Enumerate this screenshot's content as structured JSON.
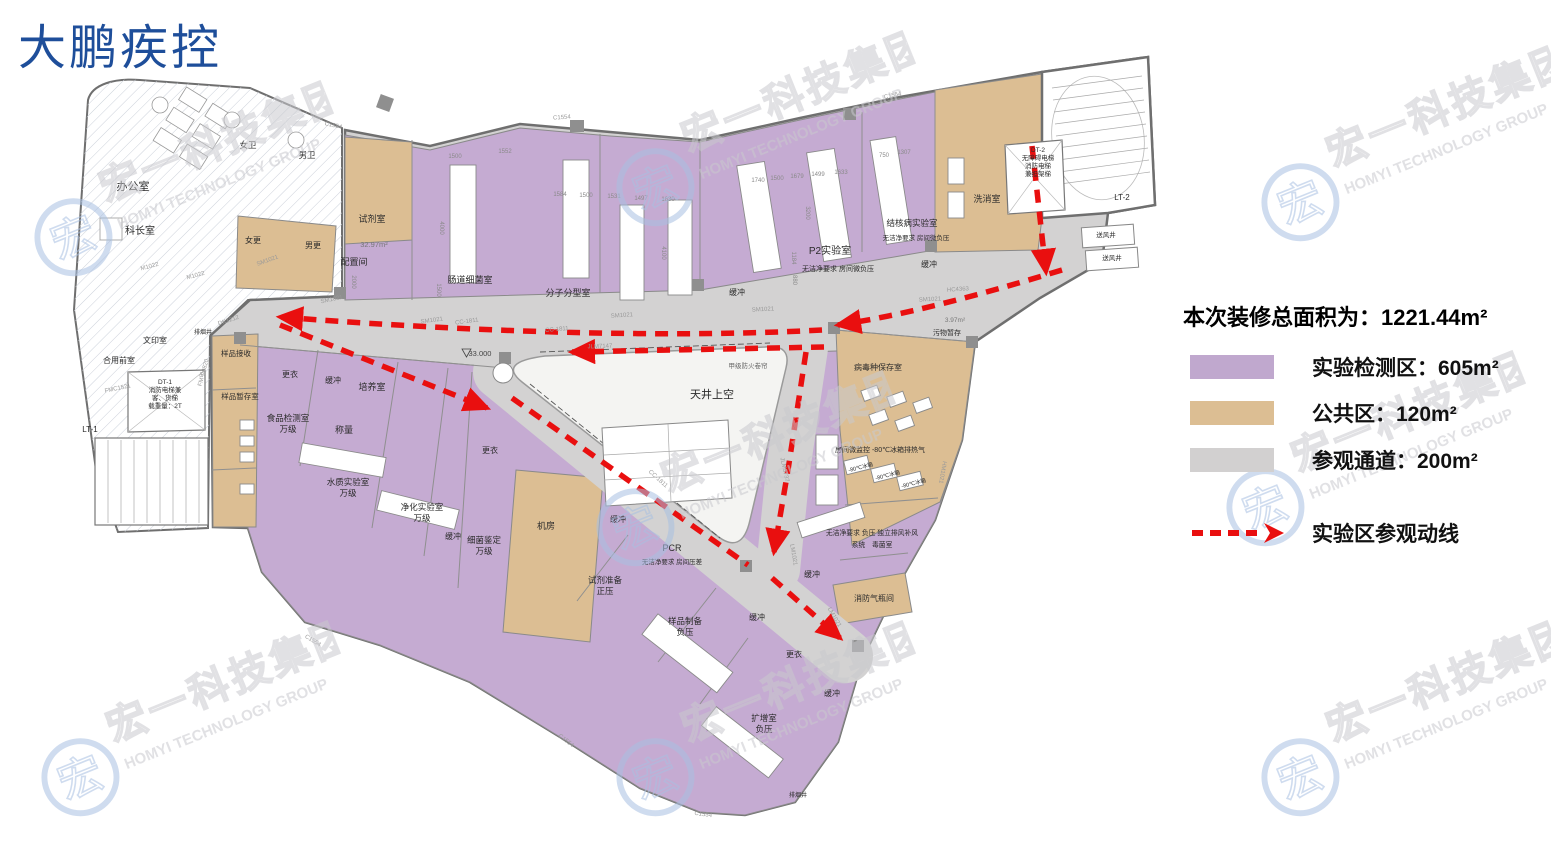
{
  "title": "大鹏疾控",
  "watermark": {
    "cn": "宏一科技集团",
    "en": "HOMYI TECHNOLOGY GROUP",
    "logo_char": "宏",
    "blue": "#a9c0e2",
    "gray": "#c9c9ce"
  },
  "legend": {
    "total_label": "本次装修总面积为：",
    "total_value": "1221.44m²",
    "items": [
      {
        "label": "实验检测区：605m²",
        "color": "#c0a8ce"
      },
      {
        "label": "公共区：120m²",
        "color": "#dcbe93"
      },
      {
        "label": "参观通道：200m²",
        "color": "#d2d0d0"
      }
    ],
    "route_label": "实验区参观动线",
    "route_color": "#e90f0f"
  },
  "floorplan": {
    "colors": {
      "lab_purple": "#c5abd2",
      "public_tan": "#dcbe93",
      "corridor_gray": "#d3d2d2",
      "route_red": "#e90f0f"
    },
    "atrium_label": "天井上空",
    "elevation_marker": "33.000",
    "rooms": [
      {
        "label": "办公室",
        "x": 133,
        "y": 190,
        "s": 11
      },
      {
        "label": "科长室",
        "x": 140,
        "y": 234,
        "s": 10
      },
      {
        "label": "女卫",
        "x": 248,
        "y": 148,
        "s": 8.5
      },
      {
        "label": "男卫",
        "x": 307,
        "y": 158,
        "s": 8.5
      },
      {
        "label": "文印室",
        "x": 155,
        "y": 343,
        "s": 8
      },
      {
        "label": "合用前室",
        "x": 119,
        "y": 363,
        "s": 8
      },
      {
        "lines": [
          "DT-1",
          "消防电梯兼",
          "客、货梯",
          "载重量：2T"
        ],
        "x": 165,
        "y": 384,
        "s": 6.5,
        "lh": 8
      },
      {
        "label": "LT-1",
        "x": 90,
        "y": 432,
        "s": 8
      },
      {
        "label": "排烟井",
        "x": 203,
        "y": 334,
        "s": 6
      },
      {
        "label": "样品接收",
        "x": 236,
        "y": 356,
        "s": 7.5
      },
      {
        "label": "样品暂存室",
        "x": 240,
        "y": 399,
        "s": 7.5
      },
      {
        "label": "女更",
        "x": 253,
        "y": 243,
        "s": 8
      },
      {
        "label": "男更",
        "x": 313,
        "y": 248,
        "s": 8
      },
      {
        "label": "试剂室",
        "x": 372,
        "y": 222,
        "s": 9
      },
      {
        "label": "32.97m²",
        "x": 374,
        "y": 247,
        "s": 7.5,
        "c": "#777777"
      },
      {
        "label": "配置间",
        "x": 354,
        "y": 265,
        "s": 9
      },
      {
        "label": "肠道细菌室",
        "x": 470,
        "y": 283,
        "s": 9
      },
      {
        "label": "分子分型室",
        "x": 568,
        "y": 296,
        "s": 9
      },
      {
        "label": "缓冲",
        "x": 737,
        "y": 295,
        "s": 8
      },
      {
        "label": "P2实验室",
        "x": 830,
        "y": 254,
        "s": 10
      },
      {
        "label": "无洁净要求  房间微负压",
        "x": 838,
        "y": 271,
        "s": 7
      },
      {
        "label": "结核病实验室",
        "x": 912,
        "y": 226,
        "s": 8.5
      },
      {
        "label": "无洁净要求  房间微负压",
        "x": 916,
        "y": 240,
        "s": 6.5
      },
      {
        "label": "缓冲",
        "x": 929,
        "y": 267,
        "s": 8
      },
      {
        "label": "洗消室",
        "x": 987,
        "y": 202,
        "s": 9
      },
      {
        "lines": [
          "DT-2",
          "无障碍电梯",
          "消防电梯",
          "兼担架梯"
        ],
        "x": 1038,
        "y": 152,
        "s": 6.5,
        "lh": 8
      },
      {
        "label": "LT-2",
        "x": 1122,
        "y": 200,
        "s": 8
      },
      {
        "label": "送风井",
        "x": 1106,
        "y": 237,
        "s": 6.5
      },
      {
        "label": "送风井",
        "x": 1112,
        "y": 260,
        "s": 6.5
      },
      {
        "label": "天井上空",
        "x": 712,
        "y": 398,
        "s": 11
      },
      {
        "label": "甲级防火卷帘",
        "x": 748,
        "y": 368,
        "s": 6.5,
        "c": "#666666"
      },
      {
        "label": "33.000",
        "x": 480,
        "y": 356,
        "s": 7.5,
        "c": "#444444"
      },
      {
        "label": "更衣",
        "x": 290,
        "y": 377,
        "s": 8
      },
      {
        "label": "缓冲",
        "x": 333,
        "y": 383,
        "s": 8
      },
      {
        "label": "培养室",
        "x": 372,
        "y": 390,
        "s": 9
      },
      {
        "lines": [
          "食品检测室",
          "万级"
        ],
        "x": 288,
        "y": 421,
        "s": 8.5,
        "lh": 11
      },
      {
        "label": "称量",
        "x": 344,
        "y": 433,
        "s": 9
      },
      {
        "lines": [
          "水质实验室",
          "万级"
        ],
        "x": 348,
        "y": 485,
        "s": 8.5,
        "lh": 11
      },
      {
        "lines": [
          "净化实验室",
          "万级"
        ],
        "x": 422,
        "y": 510,
        "s": 8.5,
        "lh": 11
      },
      {
        "label": "缓冲",
        "x": 453,
        "y": 539,
        "s": 8
      },
      {
        "lines": [
          "细菌鉴定",
          "万级"
        ],
        "x": 484,
        "y": 543,
        "s": 8.5,
        "lh": 11
      },
      {
        "label": "更衣",
        "x": 490,
        "y": 453,
        "s": 8
      },
      {
        "label": "机房",
        "x": 546,
        "y": 529,
        "s": 9
      },
      {
        "label": "缓冲",
        "x": 618,
        "y": 522,
        "s": 8
      },
      {
        "label": "PCR",
        "x": 672,
        "y": 551,
        "s": 9
      },
      {
        "label": "无洁净要求  房间压差",
        "x": 672,
        "y": 564,
        "s": 6.5
      },
      {
        "lines": [
          "试剂准备",
          "正压"
        ],
        "x": 605,
        "y": 583,
        "s": 8.5,
        "lh": 11
      },
      {
        "lines": [
          "样品制备",
          "负压"
        ],
        "x": 685,
        "y": 624,
        "s": 8.5,
        "lh": 11
      },
      {
        "label": "缓冲",
        "x": 757,
        "y": 620,
        "s": 8
      },
      {
        "label": "更衣",
        "x": 794,
        "y": 657,
        "s": 8
      },
      {
        "lines": [
          "扩增室",
          "负压"
        ],
        "x": 764,
        "y": 721,
        "s": 8.5,
        "lh": 11
      },
      {
        "label": "缓冲",
        "x": 832,
        "y": 696,
        "s": 8
      },
      {
        "label": "排烟井",
        "x": 798,
        "y": 797,
        "s": 6
      },
      {
        "label": "污物暂存",
        "x": 947,
        "y": 335,
        "s": 7
      },
      {
        "label": "3.97m²",
        "x": 955,
        "y": 322,
        "s": 6.5,
        "c": "#777777"
      },
      {
        "label": "病毒种保存室",
        "x": 878,
        "y": 370,
        "s": 8
      },
      {
        "label": "房间微监控 -80℃冰箱排热气",
        "x": 880,
        "y": 452,
        "s": 7
      },
      {
        "label": "-80℃冰箱",
        "x": 861,
        "y": 469,
        "s": 5.5,
        "r": -14
      },
      {
        "label": "-80℃冰箱",
        "x": 888,
        "y": 477,
        "s": 5.5,
        "r": -14
      },
      {
        "label": "-80℃冰箱",
        "x": 914,
        "y": 485,
        "s": 5.5,
        "r": -14
      },
      {
        "lines": [
          "无洁净要求 负压 独立排风补风",
          "系统　毒菌室"
        ],
        "x": 872,
        "y": 535,
        "s": 6.8,
        "lh": 12
      },
      {
        "label": "缓冲",
        "x": 812,
        "y": 577,
        "s": 8
      },
      {
        "label": "消防气瓶间",
        "x": 874,
        "y": 601,
        "s": 8
      }
    ],
    "dims": [
      {
        "t": "1500",
        "x": 455,
        "y": 158
      },
      {
        "t": "1552",
        "x": 505,
        "y": 153
      },
      {
        "t": "1584",
        "x": 560,
        "y": 196
      },
      {
        "t": "1500",
        "x": 586,
        "y": 197
      },
      {
        "t": "1531",
        "x": 614,
        "y": 198
      },
      {
        "t": "1497",
        "x": 641,
        "y": 200
      },
      {
        "t": "1630",
        "x": 668,
        "y": 201
      },
      {
        "t": "1740",
        "x": 758,
        "y": 182
      },
      {
        "t": "1500",
        "x": 777,
        "y": 180
      },
      {
        "t": "1679",
        "x": 797,
        "y": 178
      },
      {
        "t": "1499",
        "x": 818,
        "y": 176
      },
      {
        "t": "1633",
        "x": 841,
        "y": 174
      },
      {
        "t": "750",
        "x": 884,
        "y": 157
      },
      {
        "t": "1307",
        "x": 904,
        "y": 154
      },
      {
        "t": "4000",
        "x": 440,
        "y": 228,
        "r": 90
      },
      {
        "t": "1500",
        "x": 437,
        "y": 290,
        "r": 90
      },
      {
        "t": "4100",
        "x": 662,
        "y": 253,
        "r": 90
      },
      {
        "t": "2000",
        "x": 352,
        "y": 282,
        "r": 90
      },
      {
        "t": "3200",
        "x": 806,
        "y": 213,
        "r": 90
      },
      {
        "t": "1184",
        "x": 792,
        "y": 258,
        "r": 90
      },
      {
        "t": "880",
        "x": 793,
        "y": 280,
        "r": 90
      }
    ],
    "tags": [
      {
        "t": "M1022",
        "x": 150,
        "y": 268,
        "r": -15
      },
      {
        "t": "M1022",
        "x": 196,
        "y": 277,
        "r": -15
      },
      {
        "t": "SM1021",
        "x": 268,
        "y": 262,
        "r": -20
      },
      {
        "t": "SM1021",
        "x": 332,
        "y": 301,
        "r": -12
      },
      {
        "t": "SM1021",
        "x": 432,
        "y": 322,
        "r": -8
      },
      {
        "t": "SM1021",
        "x": 622,
        "y": 317,
        "r": -4
      },
      {
        "t": "SM1021",
        "x": 763,
        "y": 311,
        "r": -3
      },
      {
        "t": "SM1021",
        "x": 930,
        "y": 301,
        "r": -3
      },
      {
        "t": "CC-1811",
        "x": 467,
        "y": 323,
        "r": -8
      },
      {
        "t": "CC-1811",
        "x": 557,
        "y": 331,
        "r": -5
      },
      {
        "t": "CC-1811",
        "x": 657,
        "y": 480,
        "r": 42
      },
      {
        "t": "C1554",
        "x": 333,
        "y": 127,
        "r": 12
      },
      {
        "t": "C1554",
        "x": 562,
        "y": 119,
        "r": -4
      },
      {
        "t": "C1554",
        "x": 893,
        "y": 97,
        "r": -12
      },
      {
        "t": "C1554",
        "x": 312,
        "y": 642,
        "r": 32
      },
      {
        "t": "C1554",
        "x": 565,
        "y": 742,
        "r": 38
      },
      {
        "t": "C1554",
        "x": 703,
        "y": 816,
        "r": 8
      },
      {
        "t": "LM1021",
        "x": 792,
        "y": 555,
        "r": 80
      },
      {
        "t": "LM1021",
        "x": 833,
        "y": 618,
        "r": 60
      },
      {
        "t": "HC4363",
        "x": 958,
        "y": 291,
        "r": -4
      },
      {
        "t": "HM1021",
        "x": 941,
        "y": 472,
        "r": 100
      },
      {
        "t": "DK1212",
        "x": 229,
        "y": 322,
        "r": -18
      },
      {
        "t": "FMC1521",
        "x": 118,
        "y": 390,
        "r": -12
      },
      {
        "t": "FM甲0820",
        "x": 205,
        "y": 373,
        "r": -75
      },
      {
        "t": "JLM6737",
        "x": 783,
        "y": 470,
        "r": 78
      },
      {
        "t": "JLM7147",
        "x": 600,
        "y": 348,
        "r": -2
      }
    ]
  }
}
